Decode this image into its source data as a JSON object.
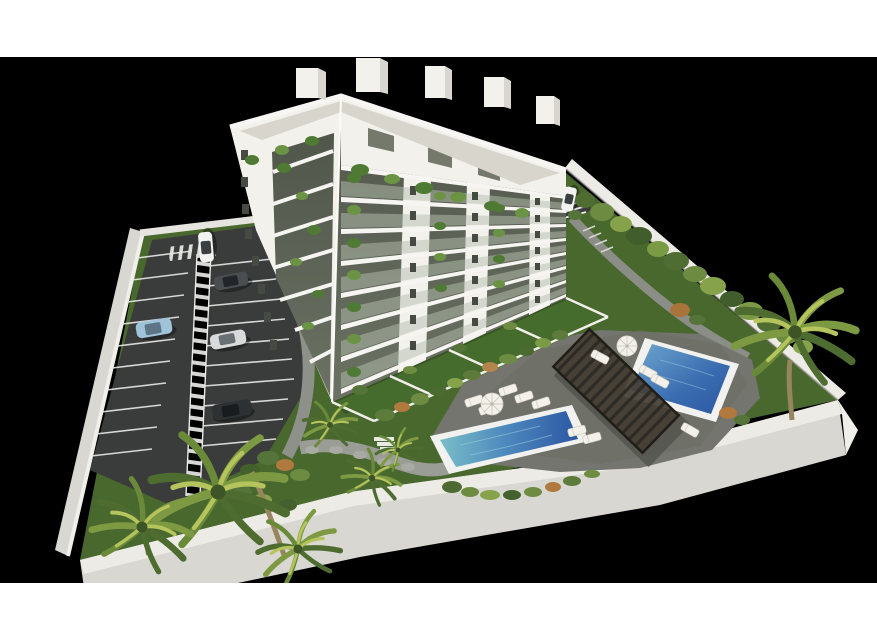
{
  "meta": {
    "content_type": "3D architectural rendering",
    "view": "aerial axonometric view of a residential complex",
    "subject": "white apartment building with landscaped garden, two swimming pools, sun deck with pergola, and private parking lot, framed by white page bands on black background"
  },
  "scene": {
    "building": {
      "label": "apartment-building",
      "balcony_floors_visible": 8,
      "penthouse_level": true,
      "balcony_plants": true,
      "ground_floor_private_gardens": 5
    },
    "pools": [
      {
        "label": "main-lap-pool",
        "shape": "long rectangle",
        "position": "bottom center"
      },
      {
        "label": "second-pool",
        "shape": "rectangle",
        "position": "right of pergola"
      }
    ],
    "amenities": {
      "pergola": 1,
      "umbrellas": 3,
      "sun_loungers": 11,
      "sun_deck": true
    },
    "parking": {
      "label": "parking-lot",
      "cars": 6,
      "striped_pedestrian_walkway": true,
      "crosswalk": true
    },
    "vegetation": {
      "palm_trees": 7,
      "hedge_row_along_wall": true,
      "lawn": true,
      "orange_accent_shrubs": true
    },
    "perimeter_wall": true,
    "entrance": {
      "position": "top right corner",
      "car_at_gate": true,
      "garden_steps": true
    }
  },
  "colors": {
    "background": "#000000",
    "page_band": "#ffffff",
    "building_light": "#f2f1ec",
    "building_shade": "#e4e1da",
    "slab": "#f6f5f1",
    "glass": "#5d6355",
    "glass_west": "#6b7365",
    "balustrade": "#b6bfb0",
    "roof_gravel": "#d8d5cd",
    "lawn": "#49682e",
    "lawn_dark": "#3a5526",
    "lawn_light": "#567a36",
    "asphalt": "#3a3c3b",
    "stripe_white": "#e9e9e7",
    "wall_top": "#edebe6",
    "wall_face": "#d9d7d1",
    "deck": "#73756e",
    "deck_shadow": "#5b5d57",
    "pavement": "#979992",
    "stone_path": "#9a9c96",
    "pool_deep": "#2d57a3",
    "pool_mid": "#4b86bc",
    "pool_shallow": "#79bdc8",
    "coping": "#f1f2ef",
    "pergola": "#453e35",
    "pergola_slat": "#2e2a24",
    "lounger": "#f3f1ea",
    "umbrella": "#f3f1ea",
    "hedge_green": "#5d7b3a",
    "shrub_orange": "#b0793e",
    "palm_light": "#b5c45c",
    "palm_mid": "#7d9a42",
    "palm_dark": "#4e6b30",
    "trunk": "#96855f",
    "car_white": "#f2f2f0",
    "car_blue": "#9fc4da",
    "car_silver": "#d9dadb",
    "car_gray": "#4a4e50",
    "car_black": "#2e3133"
  }
}
